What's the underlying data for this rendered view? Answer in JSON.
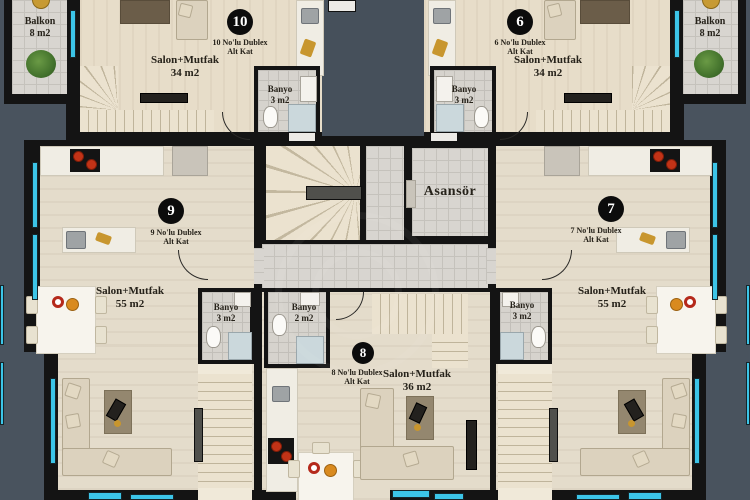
{
  "unit_labels": {
    "u10": {
      "number": "10",
      "name1": "10 No'lu Dublex",
      "name2": "Alt Kat",
      "room": "Salon+Mutfak",
      "area": "34 m2"
    },
    "u6": {
      "number": "6",
      "name1": "6 No'lu Dublex",
      "name2": "Alt Kat",
      "room": "Salon+Mutfak",
      "area": "34 m2"
    },
    "u9": {
      "number": "9",
      "name1": "9 No'lu Dublex",
      "name2": "Alt Kat",
      "room": "Salon+Mutfak",
      "area": "55 m2"
    },
    "u7": {
      "number": "7",
      "name1": "7 No'lu Dublex",
      "name2": "Alt Kat",
      "room": "Salon+Mutfak",
      "area": "55 m2"
    },
    "u8": {
      "number": "8",
      "name1": "8 No'lu Dublex",
      "name2": "Alt Kat",
      "room": "Salon+Mutfak",
      "area": "36 m2"
    }
  },
  "room_labels": {
    "elevator": "Asansör",
    "balcony_left_label": "Balkon",
    "balcony_left_area": "8 m2",
    "balcony_right_label": "Balkon",
    "balcony_right_area": "8 m2",
    "bath_u10_label": "Banyo",
    "bath_u10_area": "3 m2",
    "bath_u6_label": "Banyo",
    "bath_u6_area": "3 m2",
    "bath_u9_label": "Banyo",
    "bath_u9_area": "3 m2",
    "bath_u7_label": "Banyo",
    "bath_u7_area": "3 m2",
    "bath_u8_label": "Banyo",
    "bath_u8_area": "2 m2"
  },
  "colors": {
    "background": "#49535E",
    "wall": "#141414",
    "wood_floor": "#E7DDC9",
    "tile_floor": "#D8D5D0",
    "stair": "#EBE2CF",
    "window": "#3CC5E8",
    "accent_red": "#C23317",
    "accent_gold": "#C8962E",
    "plant_green": "#4E7D33"
  }
}
